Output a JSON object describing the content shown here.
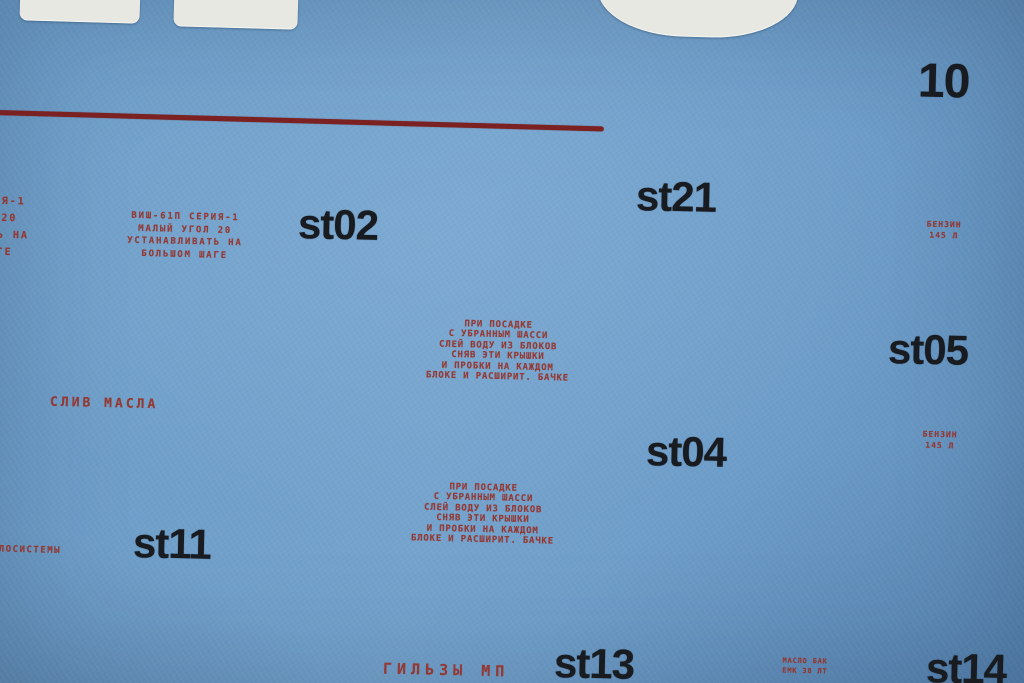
{
  "colors": {
    "paper_blue": "#6f9fca",
    "red_ink": "#97332a",
    "red_stripe": "#7b2122",
    "black_ink": "#181b20",
    "white_decal": "#e8e8e2"
  },
  "labels": {
    "n10": "10",
    "st02": "st02",
    "st21": "st21",
    "st04": "st04",
    "st05": "st05",
    "st11": "st11",
    "st13": "st13",
    "st14": "st14"
  },
  "stencils": {
    "vish": {
      "lines": [
        "ВИШ-61П СЕРИЯ-1",
        "МАЛЫЙ УГОЛ 20",
        "УСТАНАВЛИВАТЬ НА",
        "БОЛЬШОМ ШАГЕ"
      ]
    },
    "drain": {
      "lines": [
        "ПРИ ПОСАДКЕ",
        "С УБРАННЫМ ШАССИ",
        "СЛЕЙ ВОДУ ИЗ БЛОКОВ",
        "СНЯВ ЭТИ КРЫШКИ",
        "И ПРОБКИ НА КАЖДОМ",
        "БЛОКЕ И РАСШИРИТ. БАЧКЕ"
      ]
    },
    "sliv_masla": "СЛИВ МАСЛА",
    "benzin": {
      "lines": [
        "БЕНЗИН",
        "145 л"
      ]
    },
    "maslosistema": "МАСЛОСИСТЕМЫ",
    "gilzy": "ГИЛЬЗЫ МП",
    "maslo_bak": {
      "lines": [
        "МАСЛО БАК",
        "ЕМК 38 ЛТ"
      ]
    }
  }
}
